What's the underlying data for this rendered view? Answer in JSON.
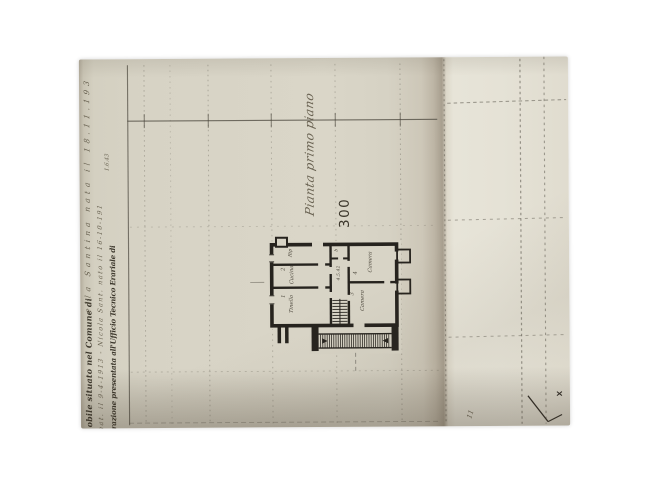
{
  "photo": {
    "form": {
      "line_comune_printed": "obile situato nel Comune di",
      "line_comune_handwritten": "ella Santina nata il 18.11.193",
      "line_dates_handwritten": "nat. il 9-4-1913 - Nicola Sant. nato il 16-10-191",
      "line_ufficio_printed": "razione presentata all'Ufficio Tecnico Erariale di",
      "note_handwritten": "1.6.43"
    },
    "drawing": {
      "title": "Pianta primo piano",
      "scale_number": "300",
      "corridor_dimension": "4.5.42",
      "rooms": [
        {
          "n": "1",
          "label": "Tinello"
        },
        {
          "n": "2",
          "label": "Cucina"
        },
        {
          "n": "3",
          "label": "Camera"
        },
        {
          "n": "4",
          "label": "Camera"
        },
        {
          "n": "",
          "label": "Rip"
        },
        {
          "n": "",
          "label": "b"
        }
      ],
      "margin_mark": "11"
    },
    "colors": {
      "paper": "#d8d4c6",
      "paper_bright": "#e6e3d7",
      "fold_shadow": "#a79e8e",
      "ink_print": "#3c372c",
      "ink_plan": "#26231e",
      "ink_hand": "#5a5342",
      "grid": "#545046"
    }
  }
}
